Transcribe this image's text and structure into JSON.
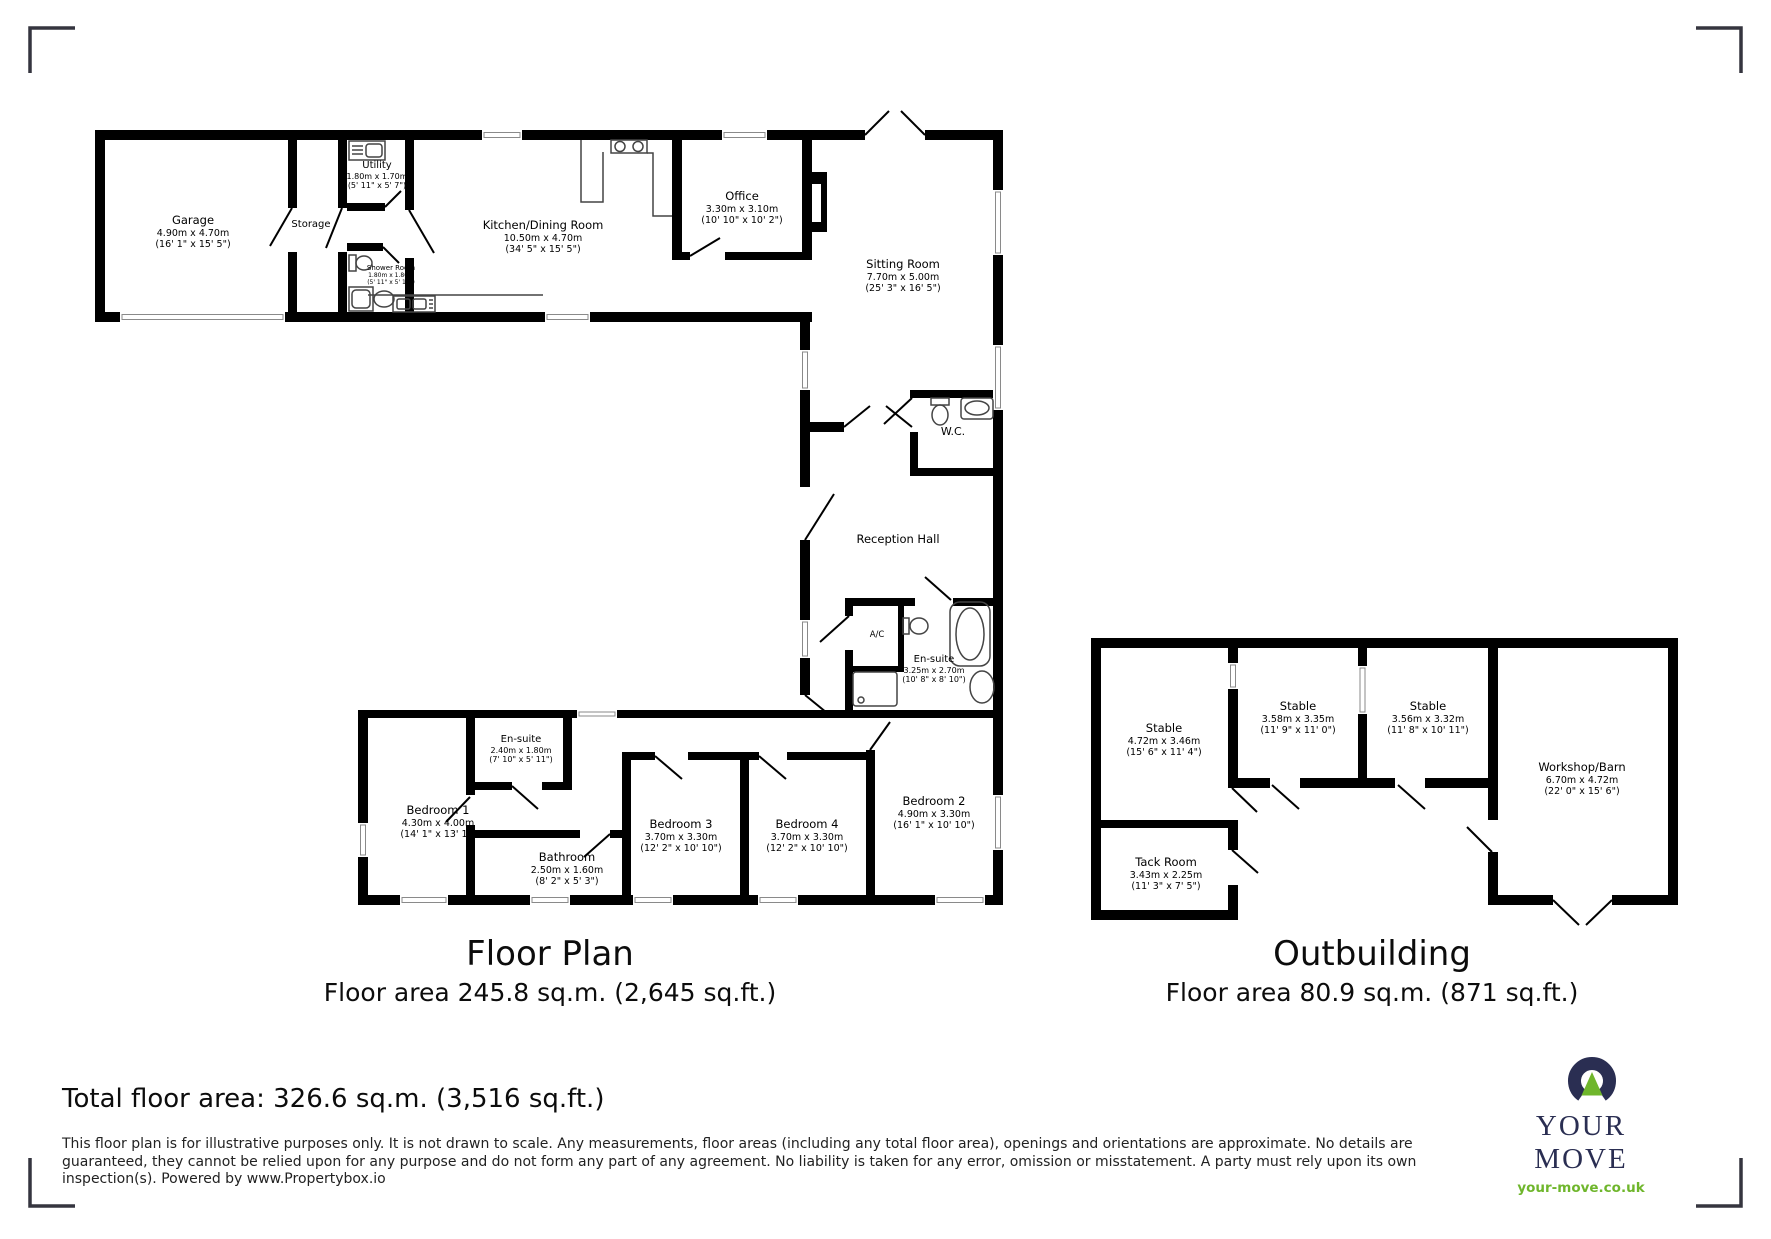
{
  "floorplan": {
    "title": "Floor Plan",
    "area": "Floor area 245.8 sq.m. (2,645 sq.ft.)",
    "rooms": {
      "garage": {
        "name": "Garage",
        "metric": "4.90m x 4.70m",
        "imperial": "(16' 1\" x 15' 5\")"
      },
      "storage": {
        "name": "Storage"
      },
      "utility": {
        "name": "Utility",
        "metric": "1.80m x 1.70m",
        "imperial": "(5' 11\" x 5' 7\")"
      },
      "shower": {
        "name": "Shower Room",
        "metric": "1.80m x 1.80m",
        "imperial": "(5' 11\" x 5' 11\")"
      },
      "kitchen": {
        "name": "Kitchen/Dining Room",
        "metric": "10.50m x 4.70m",
        "imperial": "(34' 5\" x 15' 5\")"
      },
      "office": {
        "name": "Office",
        "metric": "3.30m x 3.10m",
        "imperial": "(10' 10\" x 10' 2\")"
      },
      "sitting": {
        "name": "Sitting Room",
        "metric": "7.70m x 5.00m",
        "imperial": "(25' 3\" x 16' 5\")"
      },
      "wc": {
        "name": "W.C."
      },
      "reception": {
        "name": "Reception Hall"
      },
      "ac": {
        "name": "A/C"
      },
      "ensuite_master": {
        "name": "En-suite",
        "metric": "3.25m x 2.70m",
        "imperial": "(10' 8\" x 8' 10\")"
      },
      "bedroom1": {
        "name": "Bedroom 1",
        "metric": "4.30m x 4.00m",
        "imperial": "(14' 1\" x 13' 1\")"
      },
      "ensuite1": {
        "name": "En-suite",
        "metric": "2.40m x 1.80m",
        "imperial": "(7' 10\" x 5' 11\")"
      },
      "bathroom": {
        "name": "Bathroom",
        "metric": "2.50m x 1.60m",
        "imperial": "(8' 2\" x 5' 3\")"
      },
      "bedroom3": {
        "name": "Bedroom 3",
        "metric": "3.70m x 3.30m",
        "imperial": "(12' 2\" x 10' 10\")"
      },
      "bedroom4": {
        "name": "Bedroom 4",
        "metric": "3.70m x 3.30m",
        "imperial": "(12' 2\" x 10' 10\")"
      },
      "bedroom2": {
        "name": "Bedroom 2",
        "metric": "4.90m x 3.30m",
        "imperial": "(16' 1\" x 10' 10\")"
      }
    }
  },
  "outbuilding": {
    "title": "Outbuilding",
    "area": "Floor area 80.9 sq.m. (871 sq.ft.)",
    "rooms": {
      "stable1": {
        "name": "Stable",
        "metric": "4.72m x 3.46m",
        "imperial": "(15' 6\" x 11' 4\")"
      },
      "stable2": {
        "name": "Stable",
        "metric": "3.58m x 3.35m",
        "imperial": "(11' 9\" x 11' 0\")"
      },
      "stable3": {
        "name": "Stable",
        "metric": "3.56m x 3.32m",
        "imperial": "(11' 8\" x 10' 11\")"
      },
      "workshop": {
        "name": "Workshop/Barn",
        "metric": "6.70m x 4.72m",
        "imperial": "(22' 0\" x 15' 6\")"
      },
      "tack": {
        "name": "Tack Room",
        "metric": "3.43m x 2.25m",
        "imperial": "(11' 3\" x 7' 5\")"
      }
    }
  },
  "footer": {
    "total": "Total floor area: 326.6 sq.m. (3,516 sq.ft.)",
    "disclaimer": "This floor plan is for illustrative purposes only. It is not drawn to scale. Any measurements, floor areas (including any total floor area), openings and orientations are approximate. No details are guaranteed, they cannot be relied upon for any purpose and do not form any part of any agreement. No liability is taken for any error, omission or misstatement. A party must rely upon its own inspection(s). Powered by www.Propertybox.io"
  },
  "logo": {
    "brand": "YOUR MOVE",
    "website": "your-move.co.uk",
    "navy": "#2a2e52",
    "green": "#6fb62c"
  }
}
